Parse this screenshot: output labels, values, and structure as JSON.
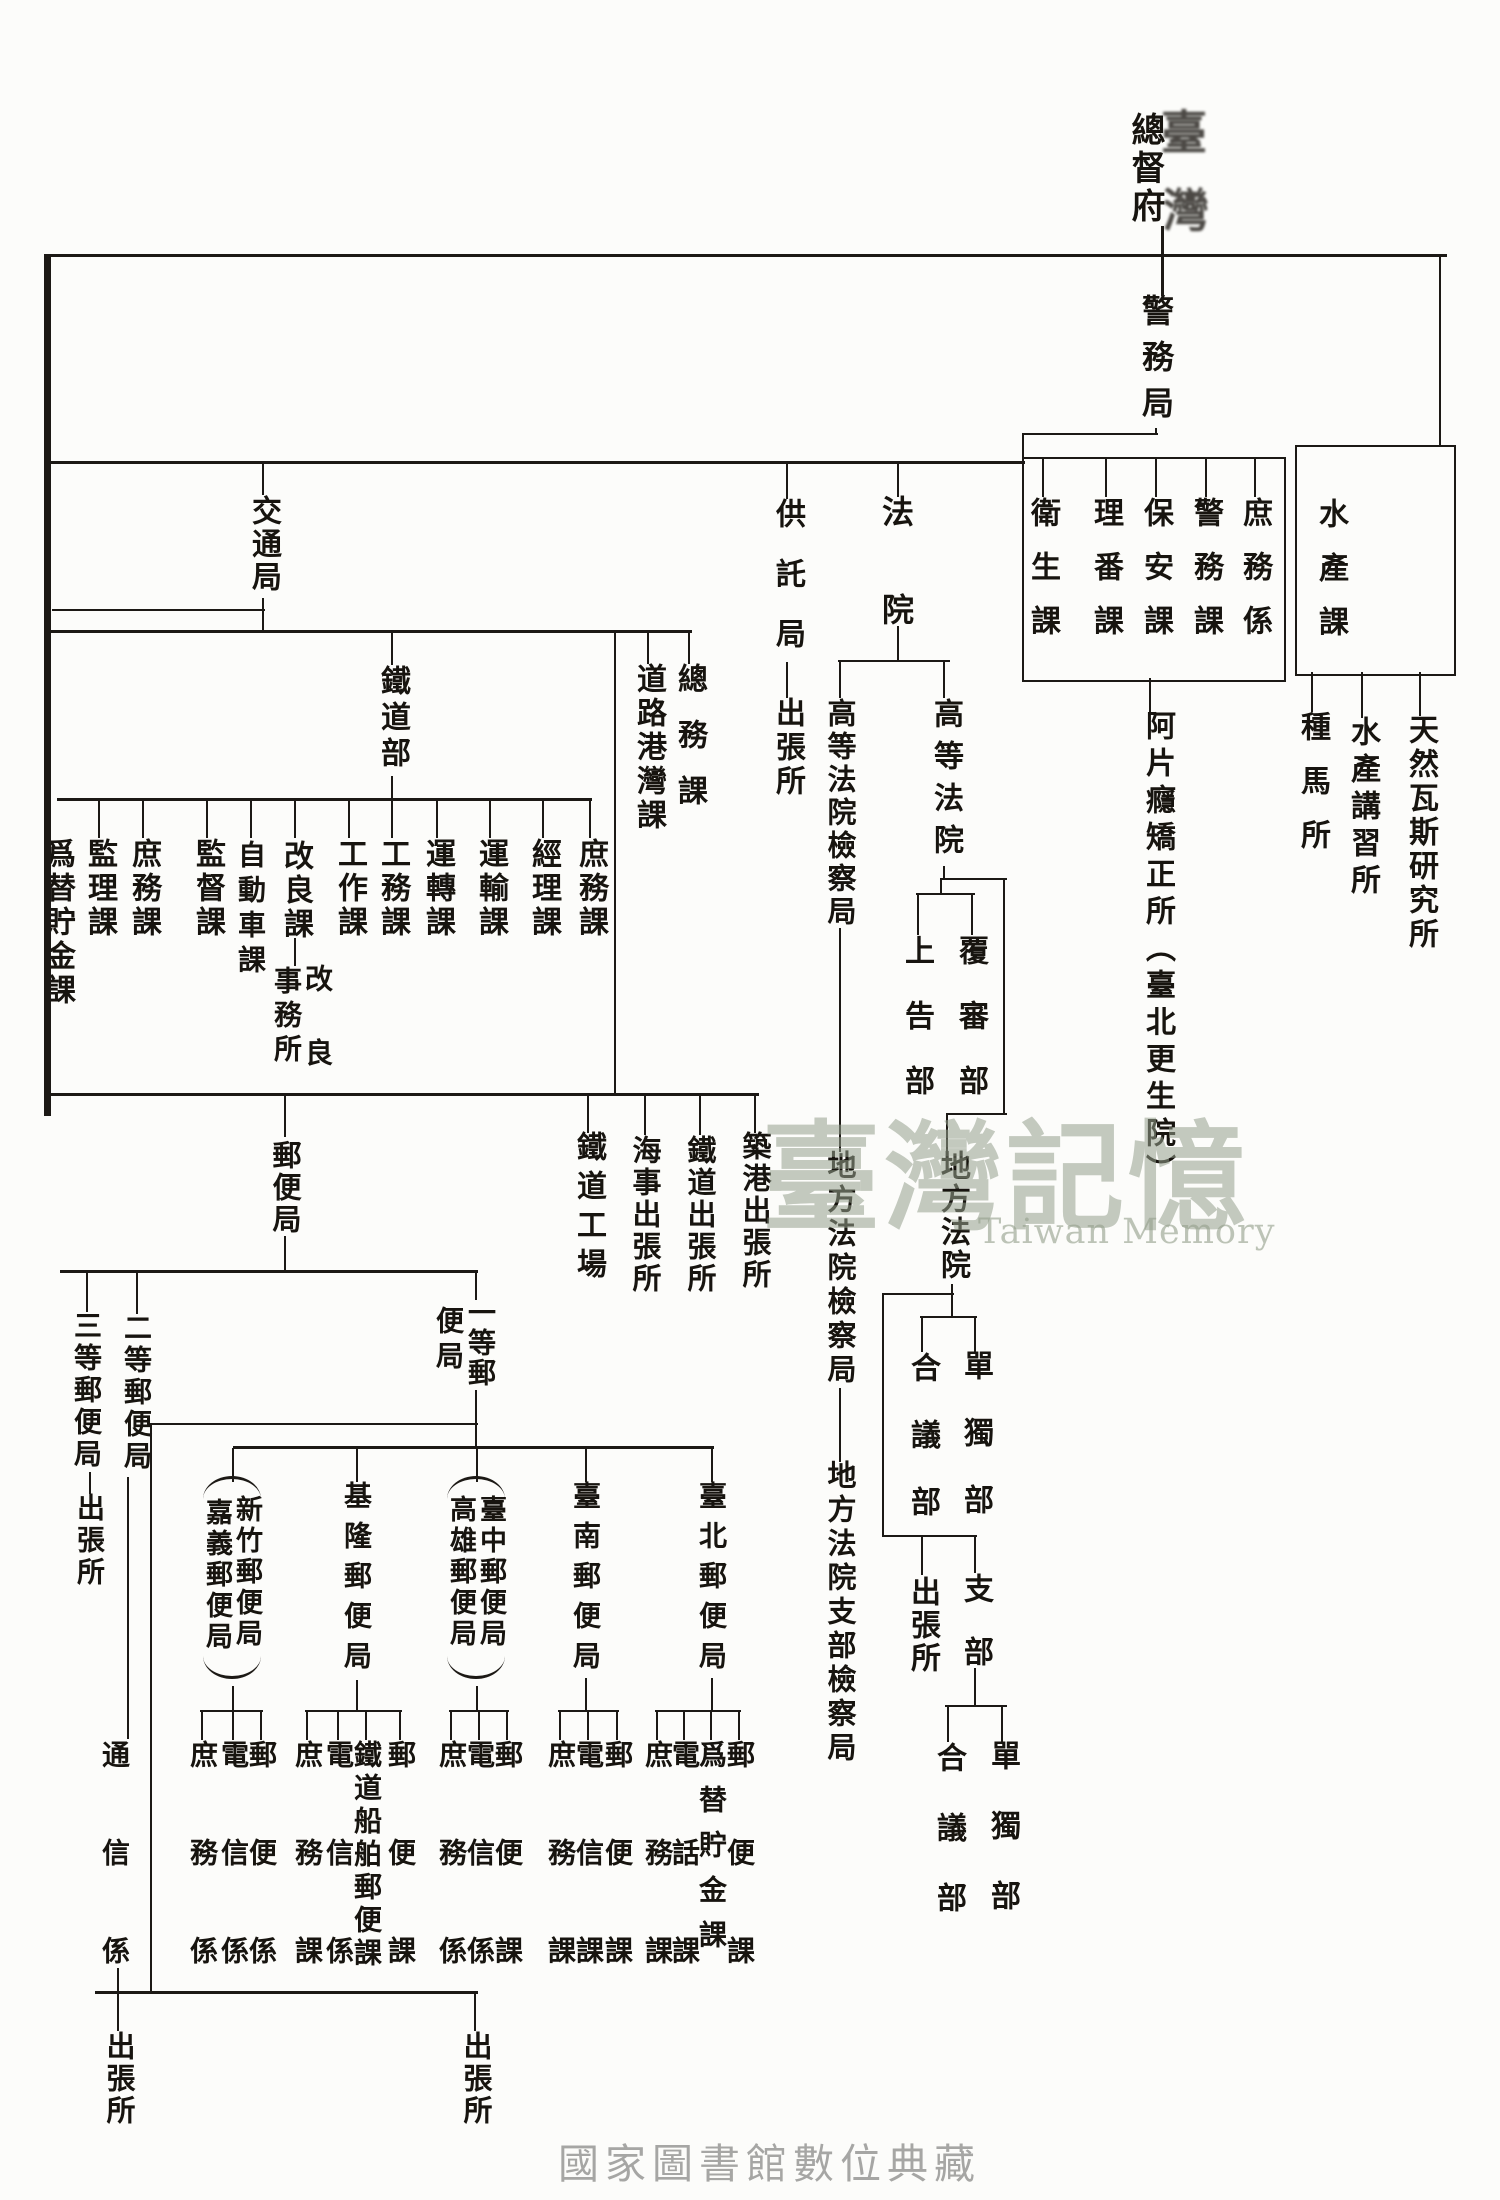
{
  "title": {
    "main": "總督府",
    "overlay1": "臺",
    "overlay2": "灣"
  },
  "nodes": {
    "keimukyoku": "警務局",
    "eisei": "衛生課",
    "riban": "理番課",
    "hoan": "保安課",
    "keimuka": "警務課",
    "shomukakari": "庶務係",
    "ahen": "阿片癮矯正所︵臺北更生院︶",
    "suisanka": "水產課",
    "shubasho": "種馬所",
    "suisankoshujo": "水產講習所",
    "tennengas": "天然瓦斯研究所",
    "kotsukyoku": "交通局",
    "tetsudobu": "鐵道部",
    "dorokowan": "道路港灣課",
    "somuka": "總務課",
    "kyotakukyoku": "供託局",
    "kyotaku_shut": "出張所",
    "hoin": "法院",
    "koto_kensatsu": "高等法院檢察局",
    "koto_hoin": "高等法院",
    "jokokubu": "上告部",
    "fukushinbu": "覆審部",
    "chiho_hoin": "地方法院",
    "chiho_kensatsu": "地方法院檢察局",
    "goigibu": "合議部",
    "tandokubu": "單獨部",
    "chiho_shut": "出張所",
    "shibu": "支部",
    "shibu_goigi": "合議部",
    "shibu_tandoku": "單獨部",
    "chiho_shibu_kensatsu": "地方法院支部檢察局",
    "kawase_edge": "爲替貯金課",
    "kanrika": "監理課",
    "shomuka1": "庶務課",
    "kantokuka": "監督課",
    "jidoshaka": "自動車課",
    "kairyoka": "改良課",
    "kairyo_r": "改良",
    "kairyo_l": "事務所",
    "kosakuka": "工作課",
    "komuka": "工務課",
    "untenka": "運轉課",
    "unyuka": "運輸課",
    "keirika": "經理課",
    "shomuka2": "庶務課",
    "tetsudokojo": "鐵道工場",
    "kaiji_shut": "海事出張所",
    "tetsudo_shut": "鐵道出張所",
    "chikko_shut": "築港出張所",
    "yubinkyoku": "郵便局",
    "santo": "三等郵便局",
    "santo_shut": "出張所",
    "nito": "二等郵便局",
    "itto_r": "一等郵",
    "itto_l": "便局",
    "tsushin": "通信係",
    "kagi": "嘉義郵便局",
    "shinchiku": "新竹郵便局",
    "kiirun": "基隆郵便局",
    "takao": "高雄郵便局",
    "taichu": "臺中郵便局",
    "tainan": "臺南郵便局",
    "taihoku": "臺北郵便局",
    "g1_shomu": "庶務係",
    "g1_denshin": "電信係",
    "g1_yubin": "郵便係",
    "g2_shomu": "庶務課",
    "g2_denshin": "電信係",
    "g2_tetsudo": "鐵道船舶郵便課",
    "g2_yubin": "郵便課",
    "g3_shomu": "庶務係",
    "g3_denshin": "電信係",
    "g3_yubin": "郵便課",
    "g4_shomu": "庶務課",
    "g4_denshin": "電信課",
    "g4_yubin": "郵便課",
    "g5_shomu": "庶務課",
    "g5_denwa": "電話課",
    "g5_kawase": "爲替貯金課",
    "g5_yubin": "郵便課",
    "shut_bl": "出張所",
    "shut_bm": "出張所"
  },
  "watermark": {
    "cjk": "臺灣記憶",
    "latin": "Taiwan Memory"
  },
  "caption": "國家圖書館數位典藏"
}
